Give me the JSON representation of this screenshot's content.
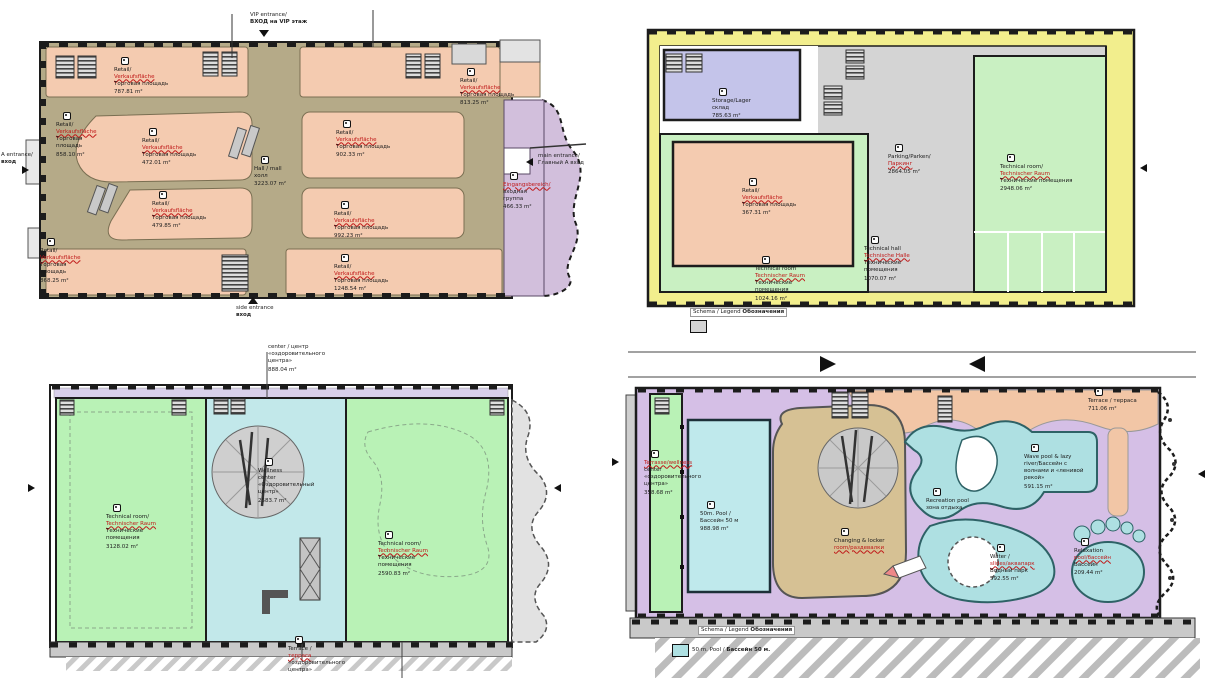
{
  "palette": {
    "salmon": "#f4cbb0",
    "corridor_olive": "#b5aa88",
    "purple_zone": "#d2bfdc",
    "yellow_band": "#f2ee8d",
    "lavender_room": "#c4c4ea",
    "gray_parking": "#d4d4d4",
    "green_tech": "#c9f0c2",
    "green_tech2": "#b9f2b6",
    "cyan_wellness": "#c2e8ea",
    "pool_cyan": "#aee0e2",
    "br_lavender": "#d5bfe6",
    "tan_changing": "#d6c194",
    "outline": "#1c1c1c",
    "label_red": "#c01818"
  },
  "plans": {
    "tl": {
      "name": "retail level plan",
      "annotations": {
        "vip1": "VIP entrance/",
        "vip2": "ВХОД на VIP этаж",
        "side1": "side entrance",
        "side2": "вход",
        "main1": "main entrance/",
        "main2": "Главный А вход",
        "left1": "A entrance/",
        "left2": "вход"
      },
      "labels": [
        {
          "t1": "Retail/",
          "t2": "Verkaufsfläche",
          "t3": "Торговая площадь",
          "area": "787.81 m²"
        },
        {
          "t1": "Retail/",
          "t2": "Verkaufsfläche",
          "t3": "Торговая площадь",
          "area": "813.25 m²"
        },
        {
          "t1": "Retail/",
          "t2": "Verkaufsfläche",
          "t3": "Торговая площадь",
          "area": "858.10 m²"
        },
        {
          "t1": "Retail/",
          "t2": "Verkaufsfläche",
          "t3": "Торговая площадь",
          "area": "472.01 m²"
        },
        {
          "t1": "Retail/",
          "t2": "Verkaufsfläche",
          "t3": "Торговая площадь",
          "area": "902.33 m²"
        },
        {
          "t1": "Hall / mall",
          "t2": "",
          "t3": "холл",
          "area": "3223.07 m²"
        },
        {
          "t1": "Retail/",
          "t2": "Verkaufsfläche",
          "t3": "Торговая площадь",
          "area": "479.85 m²"
        },
        {
          "t1": "Retail/",
          "t2": "Verkaufsfläche",
          "t3": "Торговая площадь",
          "area": "992.23 m²"
        },
        {
          "t1": "Retail/",
          "t2": "Verkaufsfläche",
          "t3": "Торговая площадь",
          "area": "868.25 m²"
        },
        {
          "t1": "Retail/",
          "t2": "Verkaufsfläche",
          "t3": "Торговая площадь",
          "area": "1248.54 m²"
        },
        {
          "t1": "",
          "t2": "Eingangsbereich/",
          "t3": "входная группа",
          "area": "466.33 m²"
        }
      ]
    },
    "tr": {
      "name": "parking and technical level plan",
      "legend": {
        "schema": "Schema / Legend ",
        "bold": "Обозначения"
      },
      "labels": [
        {
          "t1": "Storage/Lager",
          "t2": "",
          "t3": "склад",
          "area": "785.63 m²"
        },
        {
          "t1": "Retail/",
          "t2": "Verkaufsfläche",
          "t3": "Торговая площадь",
          "area": "367.31 m²"
        },
        {
          "t1": "Parking/Parken/",
          "t2": "Паркинг",
          "t3": "",
          "area": "2864.05 m²"
        },
        {
          "t1": "Technical room/",
          "t2": "Technischer Raum",
          "t3": "Технические помещения",
          "area": "2948.06 m²"
        },
        {
          "t1": "Technical room",
          "t2": "Technischer Raum",
          "t3": "Технические помещения",
          "area": "1024.16 m²"
        },
        {
          "t1": "Technical hall",
          "t2": "Technische Halle",
          "t3": "Технические помещения",
          "area": "1070.07 m²"
        }
      ]
    },
    "bl": {
      "name": "wellness level plan",
      "labels": [
        {
          "t1": "center / центр",
          "t2": "",
          "t3": "«оздоровительного центра»",
          "area": "888.04 m²"
        },
        {
          "t1": "Technical room/",
          "t2": "Technischer Raum",
          "t3": "Технические помещения",
          "area": "3128.02 m²"
        },
        {
          "t1": "Wellness",
          "t2": "",
          "t3": "center «Оздоровительный центр»",
          "area": "2583.7 m²"
        },
        {
          "t1": "Technical room/",
          "t2": "Technischer Raum",
          "t3": "Технические помещения",
          "area": "2590.83 m²"
        },
        {
          "t1": "Terrace /",
          "t2": "терраса",
          "t3": "«оздоровительного центра»",
          "area": ""
        }
      ]
    },
    "br": {
      "name": "water park level plan",
      "legend": {
        "schema": "Schema / Legend ",
        "bold": "Обозначения",
        "row1": "50 m. Pool /",
        "row1b": "Бассейн 50 м."
      },
      "labels": [
        {
          "t1": "Terrace / терраса",
          "t2": "",
          "t3": "",
          "area": "711.06 m²"
        },
        {
          "t1": "",
          "t2": "Terrasse/wellness",
          "t3": "center «оздоровительного центра»",
          "area": "358.68 m²"
        },
        {
          "t1": "50m. Pool /",
          "t2": "",
          "t3": "Бассейн 50 м",
          "area": "988.98 m²"
        },
        {
          "t1": "Changing & locker",
          "t2": "room/раздевалки",
          "t3": "",
          "area": ""
        },
        {
          "t1": "Recreation pool",
          "t2": "",
          "t3": "зона отдыха",
          "area": ""
        },
        {
          "t1": "Wave pool & lazy",
          "t2": "",
          "t3": "river/Бассейн с волнами и «ленивой рекой»",
          "area": "591.15 m²"
        },
        {
          "t1": "Water /",
          "t2": "slides/аквапарк",
          "t3": "Водный парк",
          "area": "592.55 m²"
        },
        {
          "t1": "Relaxation",
          "t2": "pool/бассейн",
          "t3": "Бассейн",
          "area": "209.44 m²"
        }
      ]
    }
  }
}
